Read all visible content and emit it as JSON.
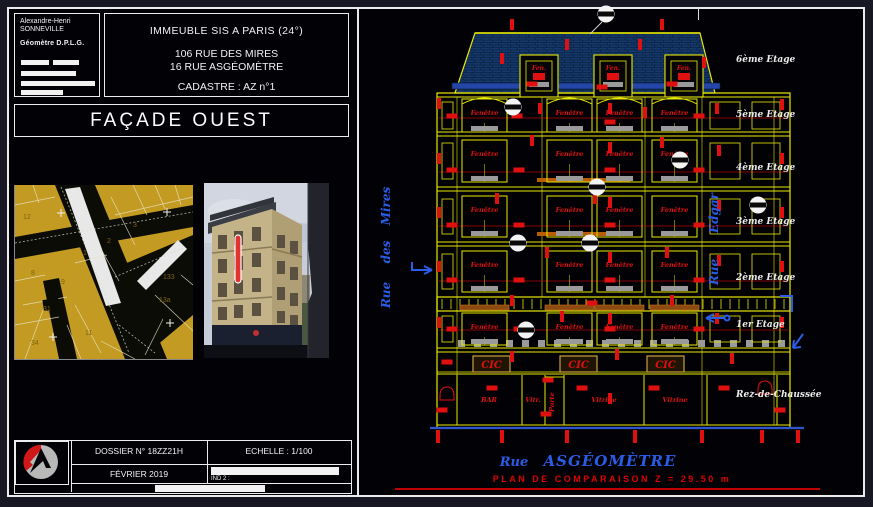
{
  "author_block": {
    "line1": "Alexandre-Henri",
    "line2": "SONNEVILLE",
    "title": "Géomètre D.P.L.G."
  },
  "project_block": {
    "title": "IMMEUBLE SIS A PARIS (24°)",
    "address1": "106 RUE DES MIRES",
    "address2": "16 RUE ASGÉOMÈTRE",
    "cadastre": "CADASTRE : AZ n°1"
  },
  "drawing_title": "FAÇADE OUEST",
  "title_block": {
    "dossier": "DOSSIER N° 18ZZ21H",
    "echelle": "ECHELLE : 1/100",
    "date": "FÉVRIER 2019",
    "ind": "IND 2 :"
  },
  "map": {
    "numbers": [
      {
        "t": "12",
        "x": 8,
        "y": 34
      },
      {
        "t": "1",
        "x": 68,
        "y": 70
      },
      {
        "t": "2",
        "x": 92,
        "y": 58
      },
      {
        "t": "3",
        "x": 118,
        "y": 42
      },
      {
        "t": "8",
        "x": 16,
        "y": 90
      },
      {
        "t": "9",
        "x": 46,
        "y": 99
      },
      {
        "t": "31",
        "x": 28,
        "y": 126
      },
      {
        "t": "11",
        "x": 70,
        "y": 150
      },
      {
        "t": "34",
        "x": 16,
        "y": 160
      },
      {
        "t": "133",
        "x": 148,
        "y": 94
      },
      {
        "t": "13a",
        "x": 144,
        "y": 117
      }
    ],
    "crosses": [
      [
        46,
        28
      ],
      [
        152,
        27
      ],
      [
        155,
        138
      ],
      [
        38,
        152
      ]
    ]
  },
  "elevation": {
    "window_label": "Fenêtre",
    "dormer_label": "Fen.",
    "sign_label": "CIC",
    "plan_comparison": "PLAN DE COMPARAISON Z = 29.50 m",
    "streets": {
      "left": [
        "Rue",
        "des",
        "Mires"
      ],
      "right": [
        "Rue",
        "Edgar"
      ],
      "bottom_rue": "Rue",
      "bottom_name": "ASGÉOMÈTRE"
    },
    "floors": [
      {
        "label": "6ème Etage",
        "y": 62
      },
      {
        "label": "5ème Etage",
        "y": 117
      },
      {
        "label": "4ème Etage",
        "y": 170
      },
      {
        "label": "3ème Etage",
        "y": 224
      },
      {
        "label": "2ème Etage",
        "y": 280
      },
      {
        "label": "1er Etage",
        "y": 327
      },
      {
        "label": "Rez-de-Chaussée",
        "y": 397
      }
    ],
    "shops": [
      {
        "label": "BAR",
        "x": 127,
        "vertical": false
      },
      {
        "label": "Vitr.",
        "x": 171,
        "vertical": false
      },
      {
        "label": "Porte",
        "x": 192,
        "vertical": true
      },
      {
        "label": "Vitrine",
        "x": 242,
        "vertical": false
      },
      {
        "label": "Vitrine",
        "x": 313,
        "vertical": false
      }
    ],
    "floors_windows": [
      {
        "y": 99,
        "h": 33,
        "cols": [
          100,
          185,
          235,
          290
        ],
        "narrow": [
          [
            80,
            11
          ],
          [
            348,
            30
          ],
          [
            390,
            28
          ]
        ],
        "arch": true,
        "lintel": false
      },
      {
        "y": 140,
        "h": 42,
        "cols": [
          100,
          185,
          235,
          290
        ],
        "narrow": [
          [
            80,
            11
          ],
          [
            348,
            30
          ],
          [
            390,
            28
          ]
        ],
        "arch": false,
        "lintel": false
      },
      {
        "y": 196,
        "h": 41,
        "cols": [
          100,
          185,
          235,
          290
        ],
        "narrow": [
          [
            80,
            11
          ],
          [
            348,
            30
          ],
          [
            390,
            28
          ]
        ],
        "arch": false,
        "lintel": false
      },
      {
        "y": 251,
        "h": 41,
        "cols": [
          100,
          185,
          235,
          290
        ],
        "narrow": [
          [
            80,
            11
          ],
          [
            348,
            30
          ],
          [
            390,
            28
          ]
        ],
        "arch": false,
        "lintel": false
      },
      {
        "y": 313,
        "h": 32,
        "cols": [
          100,
          185,
          235,
          290
        ],
        "narrow": [
          [
            80,
            11
          ],
          [
            348,
            30
          ],
          [
            390,
            28
          ]
        ],
        "arch": false,
        "lintel": true
      }
    ],
    "dormers": [
      158,
      232,
      303
    ],
    "cic_x": [
      111,
      198,
      285
    ],
    "shop_mullions": [
      95,
      160,
      183,
      202,
      282,
      345,
      415
    ],
    "guide_y": [
      118,
      172,
      226,
      281,
      330
    ],
    "tick_x": [
      76,
      140,
      205,
      273,
      340,
      400,
      436
    ],
    "circles": [
      [
        244,
        14
      ],
      [
        151,
        107
      ],
      [
        318,
        160
      ],
      [
        235,
        187
      ],
      [
        156,
        243
      ],
      [
        228,
        243
      ],
      [
        164,
        330
      ],
      [
        396,
        205
      ]
    ],
    "markers": [
      [
        140,
        58,
        "v"
      ],
      [
        205,
        44,
        "v"
      ],
      [
        278,
        44,
        "v"
      ],
      [
        342,
        62,
        "v"
      ],
      [
        150,
        24,
        "v"
      ],
      [
        300,
        24,
        "v"
      ],
      [
        170,
        84,
        "h"
      ],
      [
        240,
        87,
        "h"
      ],
      [
        310,
        84,
        "h"
      ],
      [
        77,
        103,
        "v"
      ],
      [
        90,
        116,
        "h"
      ],
      [
        155,
        116,
        "h"
      ],
      [
        248,
        108,
        "v"
      ],
      [
        248,
        122,
        "h"
      ],
      [
        337,
        116,
        "h"
      ],
      [
        355,
        108,
        "v"
      ],
      [
        420,
        104,
        "v"
      ],
      [
        178,
        108,
        "v"
      ],
      [
        283,
        112,
        "v"
      ],
      [
        77,
        158,
        "v"
      ],
      [
        90,
        170,
        "h"
      ],
      [
        157,
        170,
        "h"
      ],
      [
        248,
        147,
        "v"
      ],
      [
        248,
        170,
        "h"
      ],
      [
        337,
        170,
        "h"
      ],
      [
        357,
        150,
        "v"
      ],
      [
        420,
        158,
        "v"
      ],
      [
        170,
        140,
        "v"
      ],
      [
        300,
        142,
        "v"
      ],
      [
        77,
        212,
        "v"
      ],
      [
        90,
        225,
        "h"
      ],
      [
        157,
        225,
        "h"
      ],
      [
        248,
        202,
        "v"
      ],
      [
        248,
        225,
        "h"
      ],
      [
        337,
        225,
        "h"
      ],
      [
        357,
        205,
        "v"
      ],
      [
        420,
        212,
        "v"
      ],
      [
        233,
        198,
        "v"
      ],
      [
        135,
        198,
        "v"
      ],
      [
        77,
        266,
        "v"
      ],
      [
        90,
        280,
        "h"
      ],
      [
        157,
        280,
        "h"
      ],
      [
        248,
        257,
        "v"
      ],
      [
        248,
        280,
        "h"
      ],
      [
        337,
        280,
        "h"
      ],
      [
        357,
        260,
        "v"
      ],
      [
        420,
        266,
        "v"
      ],
      [
        305,
        252,
        "v"
      ],
      [
        185,
        252,
        "v"
      ],
      [
        150,
        300,
        "v"
      ],
      [
        310,
        300,
        "v"
      ],
      [
        230,
        303,
        "h"
      ],
      [
        77,
        322,
        "v"
      ],
      [
        90,
        329,
        "h"
      ],
      [
        157,
        329,
        "h"
      ],
      [
        248,
        318,
        "v"
      ],
      [
        248,
        329,
        "h"
      ],
      [
        337,
        329,
        "h"
      ],
      [
        420,
        322,
        "v"
      ],
      [
        200,
        316,
        "v"
      ],
      [
        355,
        318,
        "v"
      ],
      [
        150,
        356,
        "v"
      ],
      [
        255,
        354,
        "v"
      ],
      [
        370,
        358,
        "v"
      ],
      [
        85,
        362,
        "h"
      ],
      [
        130,
        388,
        "h"
      ],
      [
        220,
        388,
        "h"
      ],
      [
        292,
        388,
        "h"
      ],
      [
        362,
        388,
        "h"
      ],
      [
        80,
        410,
        "h"
      ],
      [
        418,
        410,
        "h"
      ],
      [
        186,
        380,
        "h"
      ],
      [
        184,
        414,
        "h"
      ],
      [
        248,
        398,
        "v"
      ]
    ]
  },
  "colors": {
    "yellow": "#e8e800",
    "red": "#e01010",
    "blue": "#2b5ce6",
    "roof": "#16396b",
    "roof_line": "#0a1f42",
    "gray": "#9a9a9a",
    "orange": "#b85c00",
    "map_yellow": "#c49b22",
    "map_num": "#7c6410",
    "ground_blue": "#2f55cc",
    "white": "#f0f0f0"
  }
}
